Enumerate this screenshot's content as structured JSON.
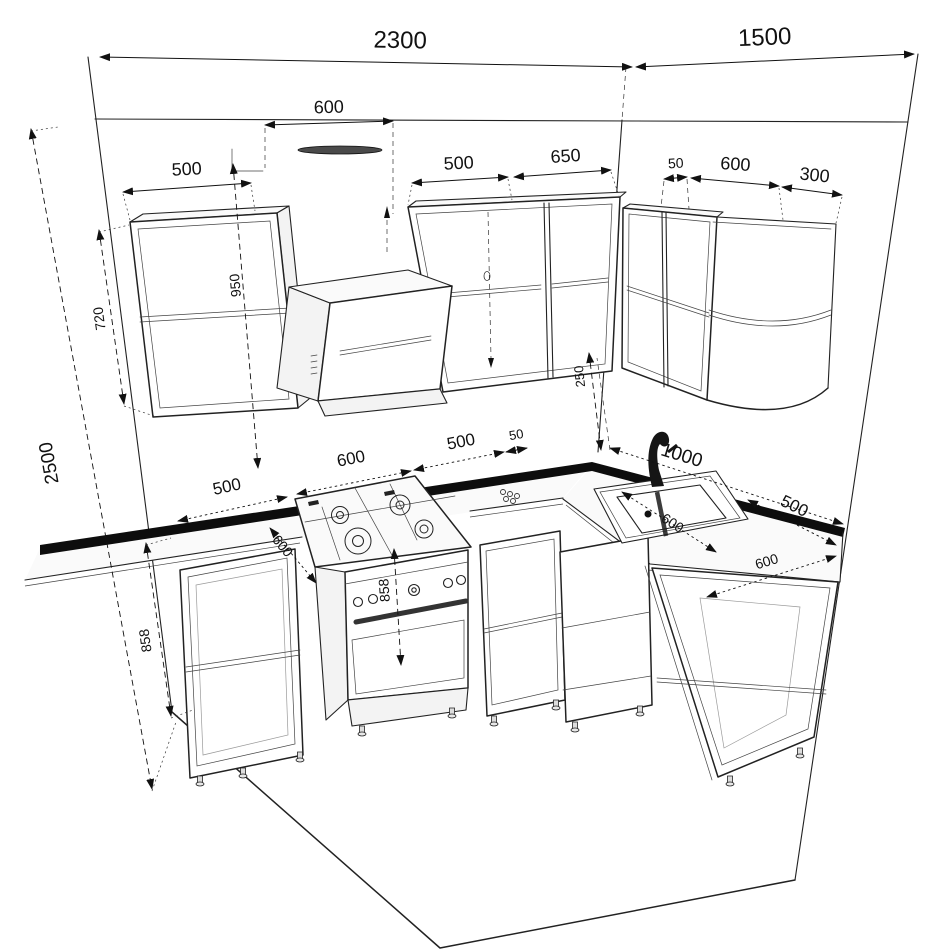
{
  "drawing": {
    "accent_color": "#111111",
    "labels": {
      "room_width_left_wall": "2300",
      "room_width_right_wall": "1500",
      "hood_clearance_width": "600",
      "wall_cabinet_left_width": "500",
      "wall_cabinet_mid_width": "500",
      "wall_cabinet_mid2_width": "650",
      "wall_corner_gap": "50",
      "wall_cabinet_right_width": "600",
      "wall_cabinet_corner_width": "300",
      "countertop_to_ceiling": "950",
      "wall_cabinet_height": "720",
      "room_height": "2500",
      "splashback_height": "250",
      "base_cabinet_left_width": "500",
      "cooker_width": "600",
      "base_cabinet_mid_width": "500",
      "base_corner_gap": "50",
      "right_counter_run": "1000",
      "base_cabinet_right_width": "500",
      "countertop_depth_left": "600",
      "cooker_height": "858",
      "sink_cabinet_depth": "600",
      "base_cabinet_right_depth": "600",
      "base_cabinet_height": "858"
    }
  }
}
